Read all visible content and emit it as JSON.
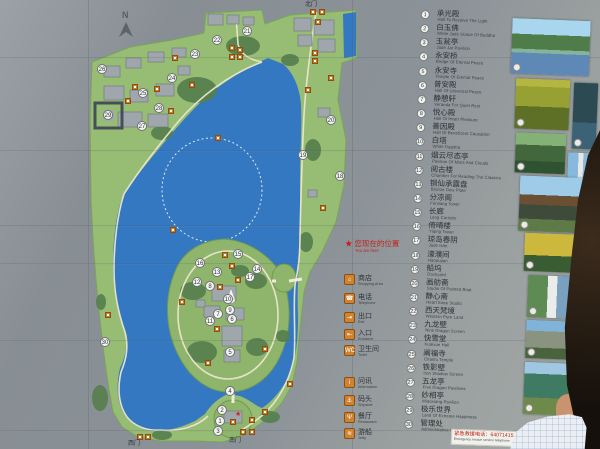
{
  "sign": {
    "compass": "N",
    "gates": {
      "north": "北门",
      "south": "南门",
      "west": "西门"
    },
    "you_are_here": {
      "zh": "您现在的位置",
      "en": "You are here"
    },
    "emergency": {
      "zh": "紧急救援电话：64071415",
      "en": "Emergency rescue service telephone"
    },
    "facility_legend": [
      {
        "icon": "shop-icon",
        "glyph": "⌂",
        "zh": "商店",
        "en": "Shopping Area",
        "y": 274
      },
      {
        "icon": "telephone-icon",
        "glyph": "☎",
        "zh": "电话",
        "en": "Telephone",
        "y": 293
      },
      {
        "icon": "exit-icon",
        "glyph": "⇥",
        "zh": "出口",
        "en": "Exit",
        "y": 312
      },
      {
        "icon": "entrance-icon",
        "glyph": "⇤",
        "zh": "入口",
        "en": "Entrance",
        "y": 329
      },
      {
        "icon": "toilet-icon",
        "glyph": "WC",
        "zh": "卫生间",
        "en": "Toilet",
        "y": 345
      },
      {
        "icon": "information-icon",
        "glyph": "i",
        "zh": "问讯",
        "en": "Information",
        "y": 377
      },
      {
        "icon": "anchor-icon",
        "glyph": "⚓",
        "zh": "码头",
        "en": "Shipside",
        "y": 395
      },
      {
        "icon": "restaurant-icon",
        "glyph": "Ψ",
        "zh": "餐厅",
        "en": "Restaurant",
        "y": 412
      },
      {
        "icon": "boat-icon",
        "glyph": "≋",
        "zh": "游船",
        "en": "Jetty",
        "y": 428
      }
    ],
    "site_legend": [
      {
        "n": 1,
        "zh": "承光殿",
        "en": "Hall To Receive The Light"
      },
      {
        "n": 2,
        "zh": "白玉佛",
        "en": "White Jade Statue Of Buddha"
      },
      {
        "n": 3,
        "zh": "玉瓮亭",
        "en": "Jade Jar Pavilion"
      },
      {
        "n": 4,
        "zh": "永安桥",
        "en": "Bridge Of Eternal Peace"
      },
      {
        "n": 5,
        "zh": "永安寺",
        "en": "Temple Of Eternal Peace"
      },
      {
        "n": 6,
        "zh": "普安殿",
        "en": "Hall Of Universal Peace"
      },
      {
        "n": 7,
        "zh": "静憩轩",
        "en": "Veranda For Quiet Rest"
      },
      {
        "n": 8,
        "zh": "悦心殿",
        "en": "Hall Of Heart Pleasure"
      },
      {
        "n": 9,
        "zh": "善因殿",
        "en": "Hall Of Beneficent Causation"
      },
      {
        "n": 10,
        "zh": "白塔",
        "en": "White Dagoba"
      },
      {
        "n": 11,
        "zh": "烟云尽态亭",
        "en": "Pavilion Of Mists And Clouds"
      },
      {
        "n": 12,
        "zh": "阅古楼",
        "en": "Chamber For Reading The Classics"
      },
      {
        "n": 13,
        "zh": "铜仙承露盘",
        "en": "Bronze Dew Plate"
      },
      {
        "n": 14,
        "zh": "分凉阁",
        "en": "Fenliang Tower"
      },
      {
        "n": 15,
        "zh": "长廊",
        "en": "Long Corridor"
      },
      {
        "n": 16,
        "zh": "倚晴楼",
        "en": "Yiqing Tower"
      },
      {
        "n": 17,
        "zh": "琼岛春阴",
        "en": "Jade Islet"
      },
      {
        "n": 18,
        "zh": "濠濮间",
        "en": "Haopujian"
      },
      {
        "n": 19,
        "zh": "船坞",
        "en": "Dockyard"
      },
      {
        "n": 20,
        "zh": "画舫斋",
        "en": "Studio Of Painted Boat"
      },
      {
        "n": 21,
        "zh": "静心斋",
        "en": "Heart Ease Studio"
      },
      {
        "n": 22,
        "zh": "西天梵境",
        "en": "Western Pure Land"
      },
      {
        "n": 23,
        "zh": "九龙壁",
        "en": "Nine Dragon Screen"
      },
      {
        "n": 24,
        "zh": "快雪堂",
        "en": "Kuaixue Hall"
      },
      {
        "n": 25,
        "zh": "阐福寺",
        "en": "Chanfu Temple"
      },
      {
        "n": 26,
        "zh": "铁影壁",
        "en": "Iron Shadow Screen"
      },
      {
        "n": 27,
        "zh": "五龙亭",
        "en": "Five Dragon Pavilions"
      },
      {
        "n": 28,
        "zh": "妙相亭",
        "en": "Miaoxiang Pavilion"
      },
      {
        "n": 29,
        "zh": "极乐世界",
        "en": "Land Of Extreme Happiness"
      },
      {
        "n": 30,
        "zh": "管理处",
        "en": "Administrative Office"
      }
    ],
    "map_numbers": [
      {
        "n": 1,
        "x": 220,
        "y": 421
      },
      {
        "n": 2,
        "x": 222,
        "y": 410
      },
      {
        "n": 3,
        "x": 218,
        "y": 431
      },
      {
        "n": 4,
        "x": 230,
        "y": 391
      },
      {
        "n": 5,
        "x": 230,
        "y": 352
      },
      {
        "n": 6,
        "x": 232,
        "y": 319
      },
      {
        "n": 7,
        "x": 218,
        "y": 314
      },
      {
        "n": 8,
        "x": 210,
        "y": 286
      },
      {
        "n": 9,
        "x": 230,
        "y": 310
      },
      {
        "n": 10,
        "x": 228,
        "y": 299
      },
      {
        "n": 11,
        "x": 210,
        "y": 321
      },
      {
        "n": 12,
        "x": 197,
        "y": 282
      },
      {
        "n": 13,
        "x": 217,
        "y": 272
      },
      {
        "n": 14,
        "x": 257,
        "y": 269
      },
      {
        "n": 15,
        "x": 238,
        "y": 254
      },
      {
        "n": 16,
        "x": 200,
        "y": 263
      },
      {
        "n": 17,
        "x": 250,
        "y": 277
      },
      {
        "n": 18,
        "x": 340,
        "y": 176
      },
      {
        "n": 19,
        "x": 303,
        "y": 155
      },
      {
        "n": 20,
        "x": 331,
        "y": 120
      },
      {
        "n": 21,
        "x": 247,
        "y": 31
      },
      {
        "n": 22,
        "x": 217,
        "y": 40
      },
      {
        "n": 23,
        "x": 195,
        "y": 54
      },
      {
        "n": 24,
        "x": 172,
        "y": 78
      },
      {
        "n": 25,
        "x": 143,
        "y": 93
      },
      {
        "n": 26,
        "x": 102,
        "y": 69
      },
      {
        "n": 27,
        "x": 142,
        "y": 126
      },
      {
        "n": 28,
        "x": 159,
        "y": 108
      },
      {
        "n": 29,
        "x": 108,
        "y": 115
      },
      {
        "n": 30,
        "x": 105,
        "y": 342
      }
    ],
    "map_facilities": [
      {
        "x": 313,
        "y": 12
      },
      {
        "x": 322,
        "y": 12
      },
      {
        "x": 318,
        "y": 22
      },
      {
        "x": 232,
        "y": 48
      },
      {
        "x": 240,
        "y": 50
      },
      {
        "x": 232,
        "y": 57
      },
      {
        "x": 240,
        "y": 57
      },
      {
        "x": 175,
        "y": 58
      },
      {
        "x": 135,
        "y": 87
      },
      {
        "x": 157,
        "y": 89
      },
      {
        "x": 128,
        "y": 101
      },
      {
        "x": 192,
        "y": 85
      },
      {
        "x": 171,
        "y": 111
      },
      {
        "x": 315,
        "y": 53
      },
      {
        "x": 315,
        "y": 61
      },
      {
        "x": 331,
        "y": 78
      },
      {
        "x": 308,
        "y": 90
      },
      {
        "x": 323,
        "y": 208
      },
      {
        "x": 108,
        "y": 315
      },
      {
        "x": 218,
        "y": 138
      },
      {
        "x": 173,
        "y": 230
      },
      {
        "x": 225,
        "y": 255
      },
      {
        "x": 232,
        "y": 266
      },
      {
        "x": 238,
        "y": 280
      },
      {
        "x": 220,
        "y": 287
      },
      {
        "x": 182,
        "y": 302
      },
      {
        "x": 217,
        "y": 329
      },
      {
        "x": 265,
        "y": 349
      },
      {
        "x": 208,
        "y": 363
      },
      {
        "x": 290,
        "y": 384
      },
      {
        "x": 265,
        "y": 412
      },
      {
        "x": 252,
        "y": 420
      },
      {
        "x": 233,
        "y": 422
      },
      {
        "x": 243,
        "y": 432
      },
      {
        "x": 252,
        "y": 432
      },
      {
        "x": 140,
        "y": 437
      },
      {
        "x": 148,
        "y": 437
      }
    ],
    "you_are_here_marker": {
      "x": 238,
      "y": 414
    },
    "photos": [
      {
        "kind": "lakeview",
        "x": 2,
        "y": 6,
        "w": 78,
        "h": 55
      },
      {
        "kind": "yellowgate",
        "x": 8,
        "y": 66,
        "w": 54,
        "h": 50
      },
      {
        "kind": "darkteal",
        "x": 66,
        "y": 68,
        "w": 24,
        "h": 66
      },
      {
        "kind": "greenhall",
        "x": 10,
        "y": 120,
        "w": 50,
        "h": 40
      },
      {
        "kind": "pagodasky",
        "x": 63,
        "y": 138,
        "w": 27,
        "h": 48
      },
      {
        "kind": "bighall",
        "x": 16,
        "y": 163,
        "w": 74,
        "h": 55
      },
      {
        "kind": "goldpav",
        "x": 23,
        "y": 220,
        "w": 56,
        "h": 38
      },
      {
        "kind": "stele",
        "x": 28,
        "y": 262,
        "w": 52,
        "h": 42
      },
      {
        "kind": "stonegate",
        "x": 28,
        "y": 307,
        "w": 56,
        "h": 38
      },
      {
        "kind": "dragonwall",
        "x": 28,
        "y": 349,
        "w": 72,
        "h": 52
      }
    ]
  },
  "colors": {
    "lake": "#3478c2",
    "land": "#97bc73",
    "tree": "#567f4d",
    "building": "#9fa6ac",
    "path": "#ece6cd",
    "marker_orange": "#cf7e2c",
    "red": "#c41f17",
    "panel_gray": "#8b9298"
  }
}
